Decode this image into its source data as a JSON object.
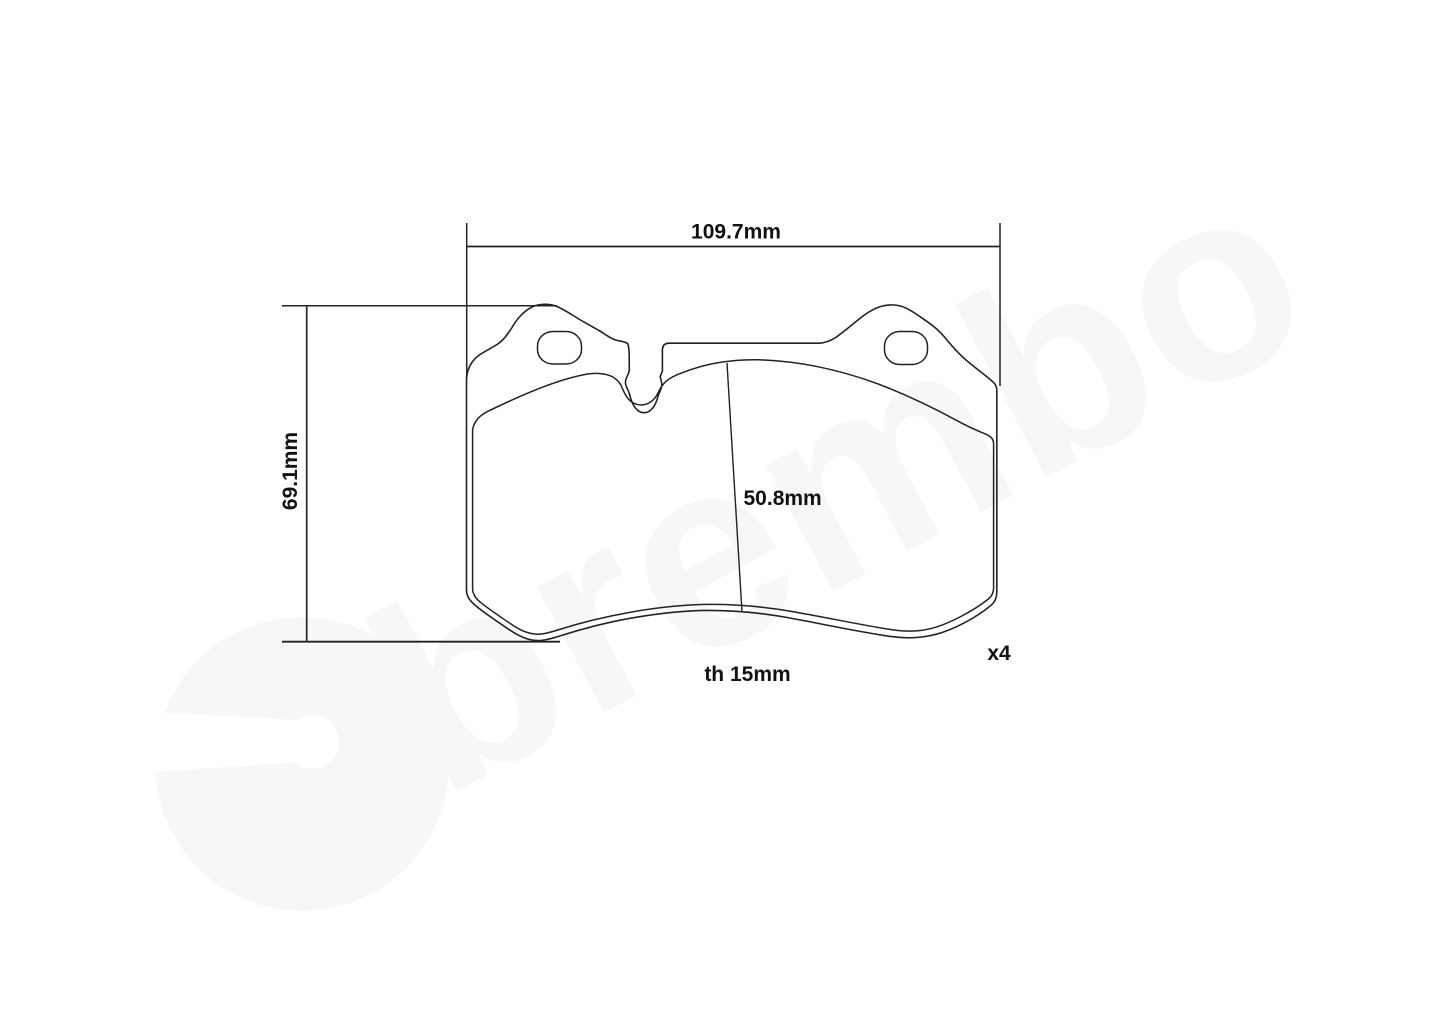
{
  "drawing": {
    "dimensions": {
      "overall_width": "109.7mm",
      "overall_height": "69.1mm",
      "pad_height": "50.8mm",
      "thickness": "th 15mm",
      "quantity": "x4"
    },
    "watermark_text": "brembo",
    "colors": {
      "line": "#222222",
      "label": "#111111",
      "watermark": "#f7f7f7",
      "background": "#ffffff"
    }
  }
}
